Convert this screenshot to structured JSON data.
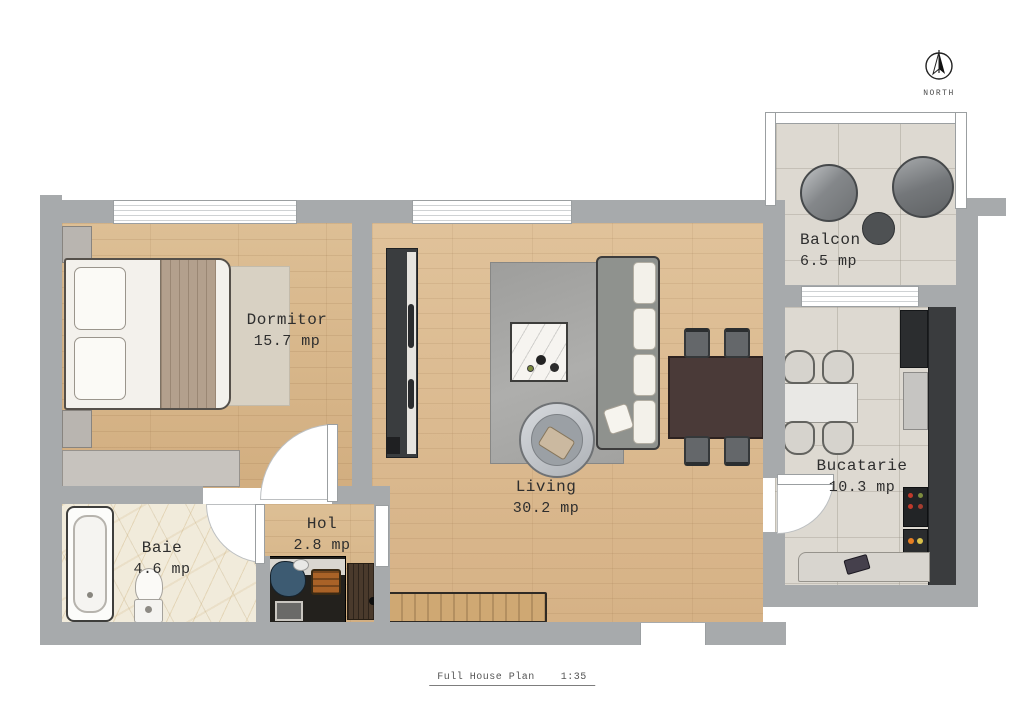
{
  "compass": {
    "label": "NORTH"
  },
  "rooms": {
    "dormitor": {
      "name": "Dormitor",
      "area": "15.7 mp"
    },
    "living": {
      "name": "Living",
      "area": "30.2 mp"
    },
    "balcon": {
      "name": "Balcon",
      "area": "6.5 mp"
    },
    "bucatarie": {
      "name": "Bucatarie",
      "area": "10.3 mp"
    },
    "baie": {
      "name": "Baie",
      "area": "4.6 mp"
    },
    "hol": {
      "name": "Hol",
      "area": "2.8 mp"
    }
  },
  "title_block": {
    "label": "Full House Plan",
    "scale": "1:35"
  },
  "colors": {
    "wall": "#a7aaac",
    "wood_floor": "#d8b78b",
    "tile_floor": "#ddd9d1",
    "marble_floor": "#f1ebdb",
    "counter_dark": "#3a3c3e",
    "sofa_gray": "#8f928e",
    "dining_table_brown": "#4a3a38",
    "blanket_tan": "#b3a08d"
  }
}
